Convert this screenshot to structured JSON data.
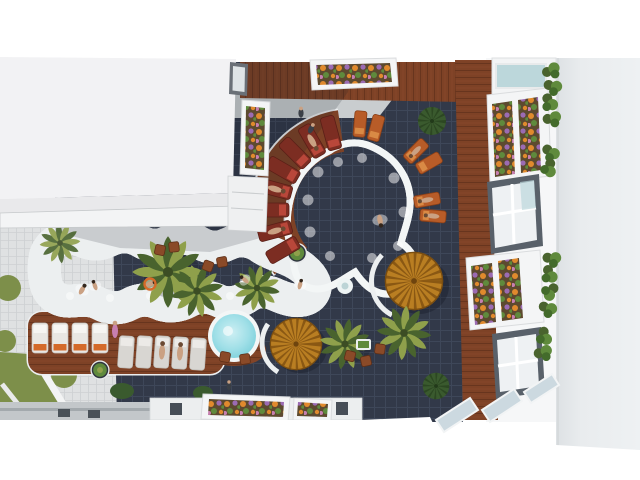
{
  "scene": {
    "type": "aerial-architectural-render",
    "description": "Top-down 3D architectural rendering of a residential complex courtyard: a freeform turquoise swimming pool with a wavy lazy-river arm and a round jacuzzi, dark navy tiled deck, reddish wooden sun decks, white and orange sun loungers, radial maroon loungers around the main pool, two amber thatched parasols, top-down palm trees, flower planter boxes, green hedges, a large white roof on the left and a white apartment facade with balconies on the right.",
    "objects": {
      "pools": 3,
      "swimmers": 6,
      "palm-trees": 6,
      "thatch-parasols": 2,
      "sun-loungers": 23,
      "flower-planters": 9,
      "hedge-bushes": 12,
      "round-bushes": 2,
      "grass-patches": 5,
      "people-standing": 3
    }
  },
  "palette": {
    "bg-white": "#ffffff",
    "roof-left": "#f2f2f4",
    "roof-right": "#e9ecee",
    "facade-white": "#f6f7f8",
    "tile-dark": "#323949",
    "tile-dark-line": "#404a5c",
    "tile-light": "#dfe1e2",
    "tile-light-line": "#cdd0d2",
    "wood": "#7e4226",
    "wood-dark": "#5e2f1a",
    "wood-light": "#95522f",
    "water-light": "#cdeff3",
    "water-mid": "#9fdfe7",
    "water-deep": "#74ccd8",
    "rim-white": "#f3f6f6",
    "parasol-amber": "#b97e22",
    "parasol-dark": "#8a5813",
    "palm-green": "#8fa04b",
    "palm-dark": "#49632e",
    "bush-green": "#3a5a2e",
    "grass-green": "#7d8f4a",
    "lounger-white": "#e9e7e3",
    "lounger-gray": "#d8d6d2",
    "towel-orange": "#d46a2a",
    "lounger-maroon": "#7c2d22",
    "lounger-orange": "#b85c28",
    "flower-orange": "#e08a2d",
    "flower-purple": "#9b6bb3",
    "flower-pink": "#c77fb0",
    "leaf-green": "#5f8a3c",
    "soil-brown": "#5d4a2f",
    "skin": "#caa183",
    "concrete": "#c3c7ca",
    "marble": "#c9cdcf",
    "glass": "#bcd7db"
  }
}
